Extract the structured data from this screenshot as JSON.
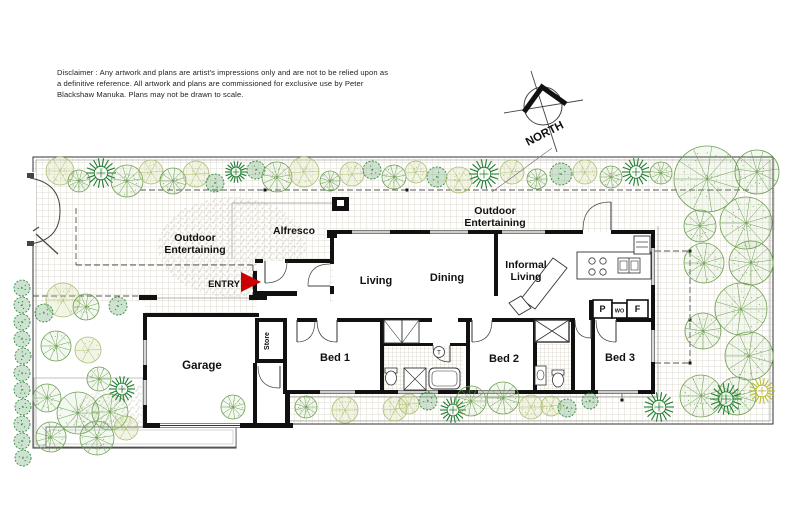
{
  "disclaimer": {
    "line1": "Disclaimer : Any artwork and plans are artist's impressions only and are not to be relied upon as",
    "line2": "a definitive reference. All artwork and plans are commissioned for exclusive use by Peter",
    "line3": "Blackshaw Manuka. Plans may not be drawn to scale."
  },
  "compass": {
    "label": "NORTH"
  },
  "entry": {
    "label": "ENTRY",
    "arrow_color": "#cc0000"
  },
  "rooms": [
    {
      "id": "garage",
      "lines": [
        "Garage"
      ],
      "x": 202,
      "y": 369,
      "size": 11.5
    },
    {
      "id": "store",
      "lines": [
        "Store"
      ],
      "x": 269,
      "y": 341,
      "size": 7,
      "rotate": -90
    },
    {
      "id": "bed1",
      "lines": [
        "Bed 1"
      ],
      "x": 335,
      "y": 361,
      "size": 11
    },
    {
      "id": "bed2",
      "lines": [
        "Bed 2"
      ],
      "x": 504,
      "y": 362,
      "size": 11
    },
    {
      "id": "bed3",
      "lines": [
        "Bed 3"
      ],
      "x": 620,
      "y": 361,
      "size": 11
    },
    {
      "id": "living",
      "lines": [
        "Living"
      ],
      "x": 376,
      "y": 284,
      "size": 11
    },
    {
      "id": "dining",
      "lines": [
        "Dining"
      ],
      "x": 447,
      "y": 281,
      "size": 11
    },
    {
      "id": "informal-living",
      "lines": [
        "Informal",
        "Living"
      ],
      "x": 526,
      "y": 268,
      "size": 10.5
    },
    {
      "id": "alfresco",
      "lines": [
        "Alfresco"
      ],
      "x": 294,
      "y": 234,
      "size": 10.5
    },
    {
      "id": "outdoor-entertaining-west",
      "lines": [
        "Outdoor",
        "Entertaining"
      ],
      "x": 195,
      "y": 241,
      "size": 10.5
    },
    {
      "id": "outdoor-entertaining-east",
      "lines": [
        "Outdoor",
        "Entertaining"
      ],
      "x": 495,
      "y": 214,
      "size": 10.5
    }
  ],
  "kitchen": {
    "pantry": "P",
    "wall_oven": "WO",
    "fridge": "F"
  },
  "fixtures": {
    "trough": "T"
  },
  "colors": {
    "wall": "#111111",
    "entry_arrow": "#cc0000",
    "grid_line": "#d6d0c2",
    "stipple": "#b5ad98",
    "tree_green": "#6b9e4f",
    "tree_light": "#a9bf72",
    "tree_dark": "#1e7d32",
    "tree_yellow": "#b9bd2f",
    "dash": "#555555"
  },
  "trees": [
    [
      60,
      171,
      14,
      "L"
    ],
    [
      79,
      181,
      11,
      "R"
    ],
    [
      101,
      173,
      15,
      "S"
    ],
    [
      127,
      181,
      16,
      "R"
    ],
    [
      151,
      172,
      12,
      "L"
    ],
    [
      173,
      181,
      13,
      "R"
    ],
    [
      196,
      174,
      13,
      "L"
    ],
    [
      215,
      183,
      9,
      "B"
    ],
    [
      236,
      172,
      11,
      "S"
    ],
    [
      256,
      170,
      9,
      "B"
    ],
    [
      277,
      177,
      15,
      "R"
    ],
    [
      304,
      172,
      15,
      "L"
    ],
    [
      330,
      181,
      10,
      "R"
    ],
    [
      352,
      174,
      12,
      "L"
    ],
    [
      372,
      170,
      9,
      "B"
    ],
    [
      394,
      177,
      12,
      "R"
    ],
    [
      416,
      172,
      11,
      "L"
    ],
    [
      437,
      177,
      10,
      "B"
    ],
    [
      459,
      180,
      13,
      "L"
    ],
    [
      484,
      174,
      15,
      "S"
    ],
    [
      512,
      172,
      12,
      "L"
    ],
    [
      537,
      179,
      10,
      "R"
    ],
    [
      561,
      174,
      11,
      "B"
    ],
    [
      585,
      172,
      12,
      "L"
    ],
    [
      611,
      177,
      11,
      "R"
    ],
    [
      636,
      172,
      14,
      "S"
    ],
    [
      661,
      173,
      11,
      "R"
    ],
    [
      707,
      179,
      33,
      "R"
    ],
    [
      757,
      172,
      22,
      "R"
    ],
    [
      700,
      226,
      16,
      "R"
    ],
    [
      746,
      223,
      26,
      "R"
    ],
    [
      704,
      263,
      20,
      "R"
    ],
    [
      751,
      263,
      22,
      "R"
    ],
    [
      741,
      309,
      26,
      "R"
    ],
    [
      703,
      331,
      18,
      "R"
    ],
    [
      749,
      356,
      24,
      "R"
    ],
    [
      737,
      396,
      19,
      "R"
    ],
    [
      701,
      396,
      21,
      "R"
    ],
    [
      762,
      391,
      13,
      "Y"
    ],
    [
      726,
      399,
      16,
      "S"
    ],
    [
      233,
      407,
      12,
      "R"
    ],
    [
      306,
      407,
      11,
      "R"
    ],
    [
      345,
      410,
      13,
      "L"
    ],
    [
      395,
      409,
      12,
      "L"
    ],
    [
      409,
      404,
      10,
      "L"
    ],
    [
      428,
      401,
      9,
      "B"
    ],
    [
      453,
      410,
      13,
      "S"
    ],
    [
      471,
      401,
      15,
      "R"
    ],
    [
      503,
      398,
      16,
      "R"
    ],
    [
      531,
      407,
      12,
      "L"
    ],
    [
      551,
      406,
      10,
      "L"
    ],
    [
      567,
      408,
      9,
      "B"
    ],
    [
      590,
      401,
      8,
      "B"
    ],
    [
      659,
      407,
      15,
      "S"
    ],
    [
      47,
      398,
      14,
      "R"
    ],
    [
      78,
      413,
      21,
      "R"
    ],
    [
      110,
      412,
      18,
      "R"
    ],
    [
      51,
      437,
      15,
      "R"
    ],
    [
      97,
      438,
      17,
      "R"
    ],
    [
      126,
      428,
      12,
      "L"
    ],
    [
      122,
      389,
      13,
      "S"
    ],
    [
      99,
      379,
      12,
      "R"
    ],
    [
      56,
      346,
      15,
      "R"
    ],
    [
      88,
      350,
      13,
      "L"
    ],
    [
      63,
      300,
      17,
      "L"
    ],
    [
      86,
      307,
      13,
      "R"
    ],
    [
      44,
      313,
      9,
      "B"
    ],
    [
      118,
      306,
      9,
      "B"
    ],
    [
      22,
      288,
      8,
      "B"
    ],
    [
      22,
      305,
      8,
      "B"
    ],
    [
      22,
      322,
      8,
      "B"
    ],
    [
      22,
      339,
      8,
      "B"
    ],
    [
      23,
      356,
      8,
      "B"
    ],
    [
      22,
      373,
      8,
      "B"
    ],
    [
      22,
      390,
      8,
      "B"
    ],
    [
      23,
      407,
      8,
      "B"
    ],
    [
      22,
      424,
      8,
      "B"
    ],
    [
      22,
      441,
      8,
      "B"
    ],
    [
      23,
      458,
      8,
      "B"
    ]
  ]
}
